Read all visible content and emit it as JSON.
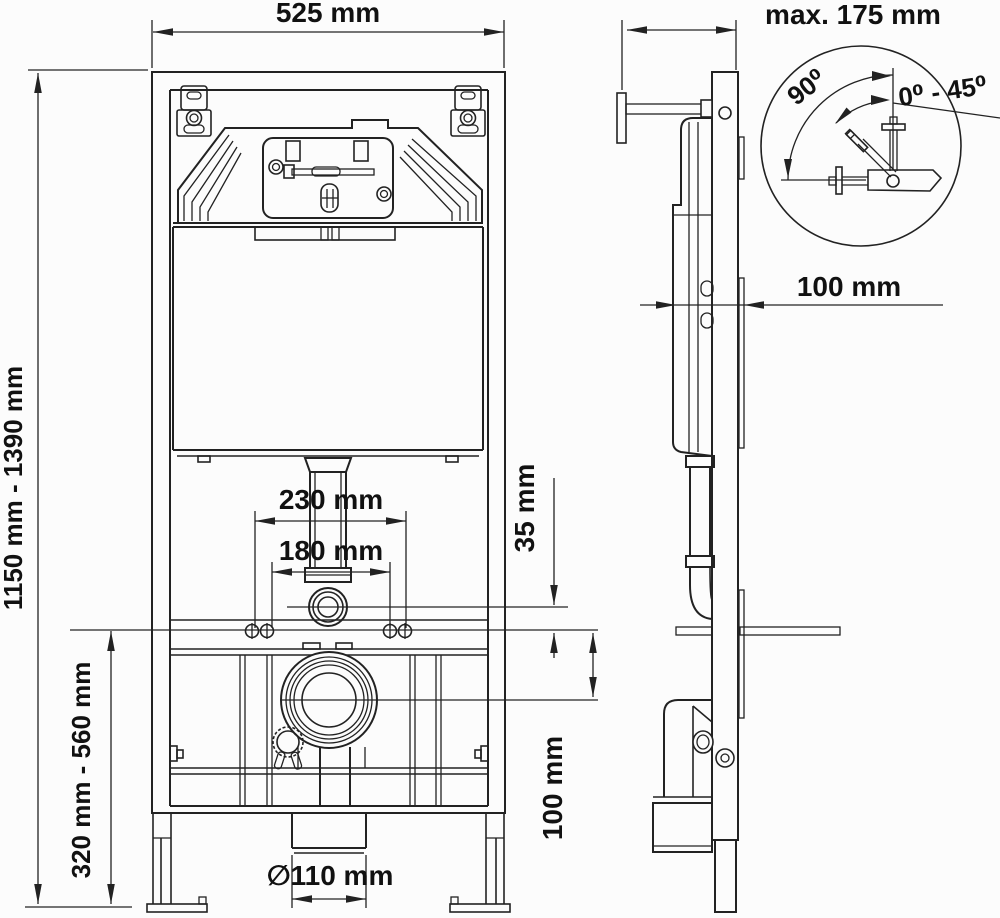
{
  "drawing": {
    "labels": {
      "front_width": "525 mm",
      "front_height_range": "1150 mm - 1390 mm",
      "mount_height_range": "320 mm - 560 mm",
      "spacing_outer": "230 mm",
      "spacing_inner": "180 mm",
      "offset_small": "35 mm",
      "offset_drain": "100 mm",
      "drain_diameter": "∅110 mm",
      "depth_max": "max. 175 mm",
      "frame_depth": "100 mm",
      "angle_upright": "90⁰",
      "angle_range": "0⁰ - 45⁰"
    },
    "colors": {
      "line": "#222222",
      "text": "#111111",
      "background": "#fcfcfc"
    }
  }
}
